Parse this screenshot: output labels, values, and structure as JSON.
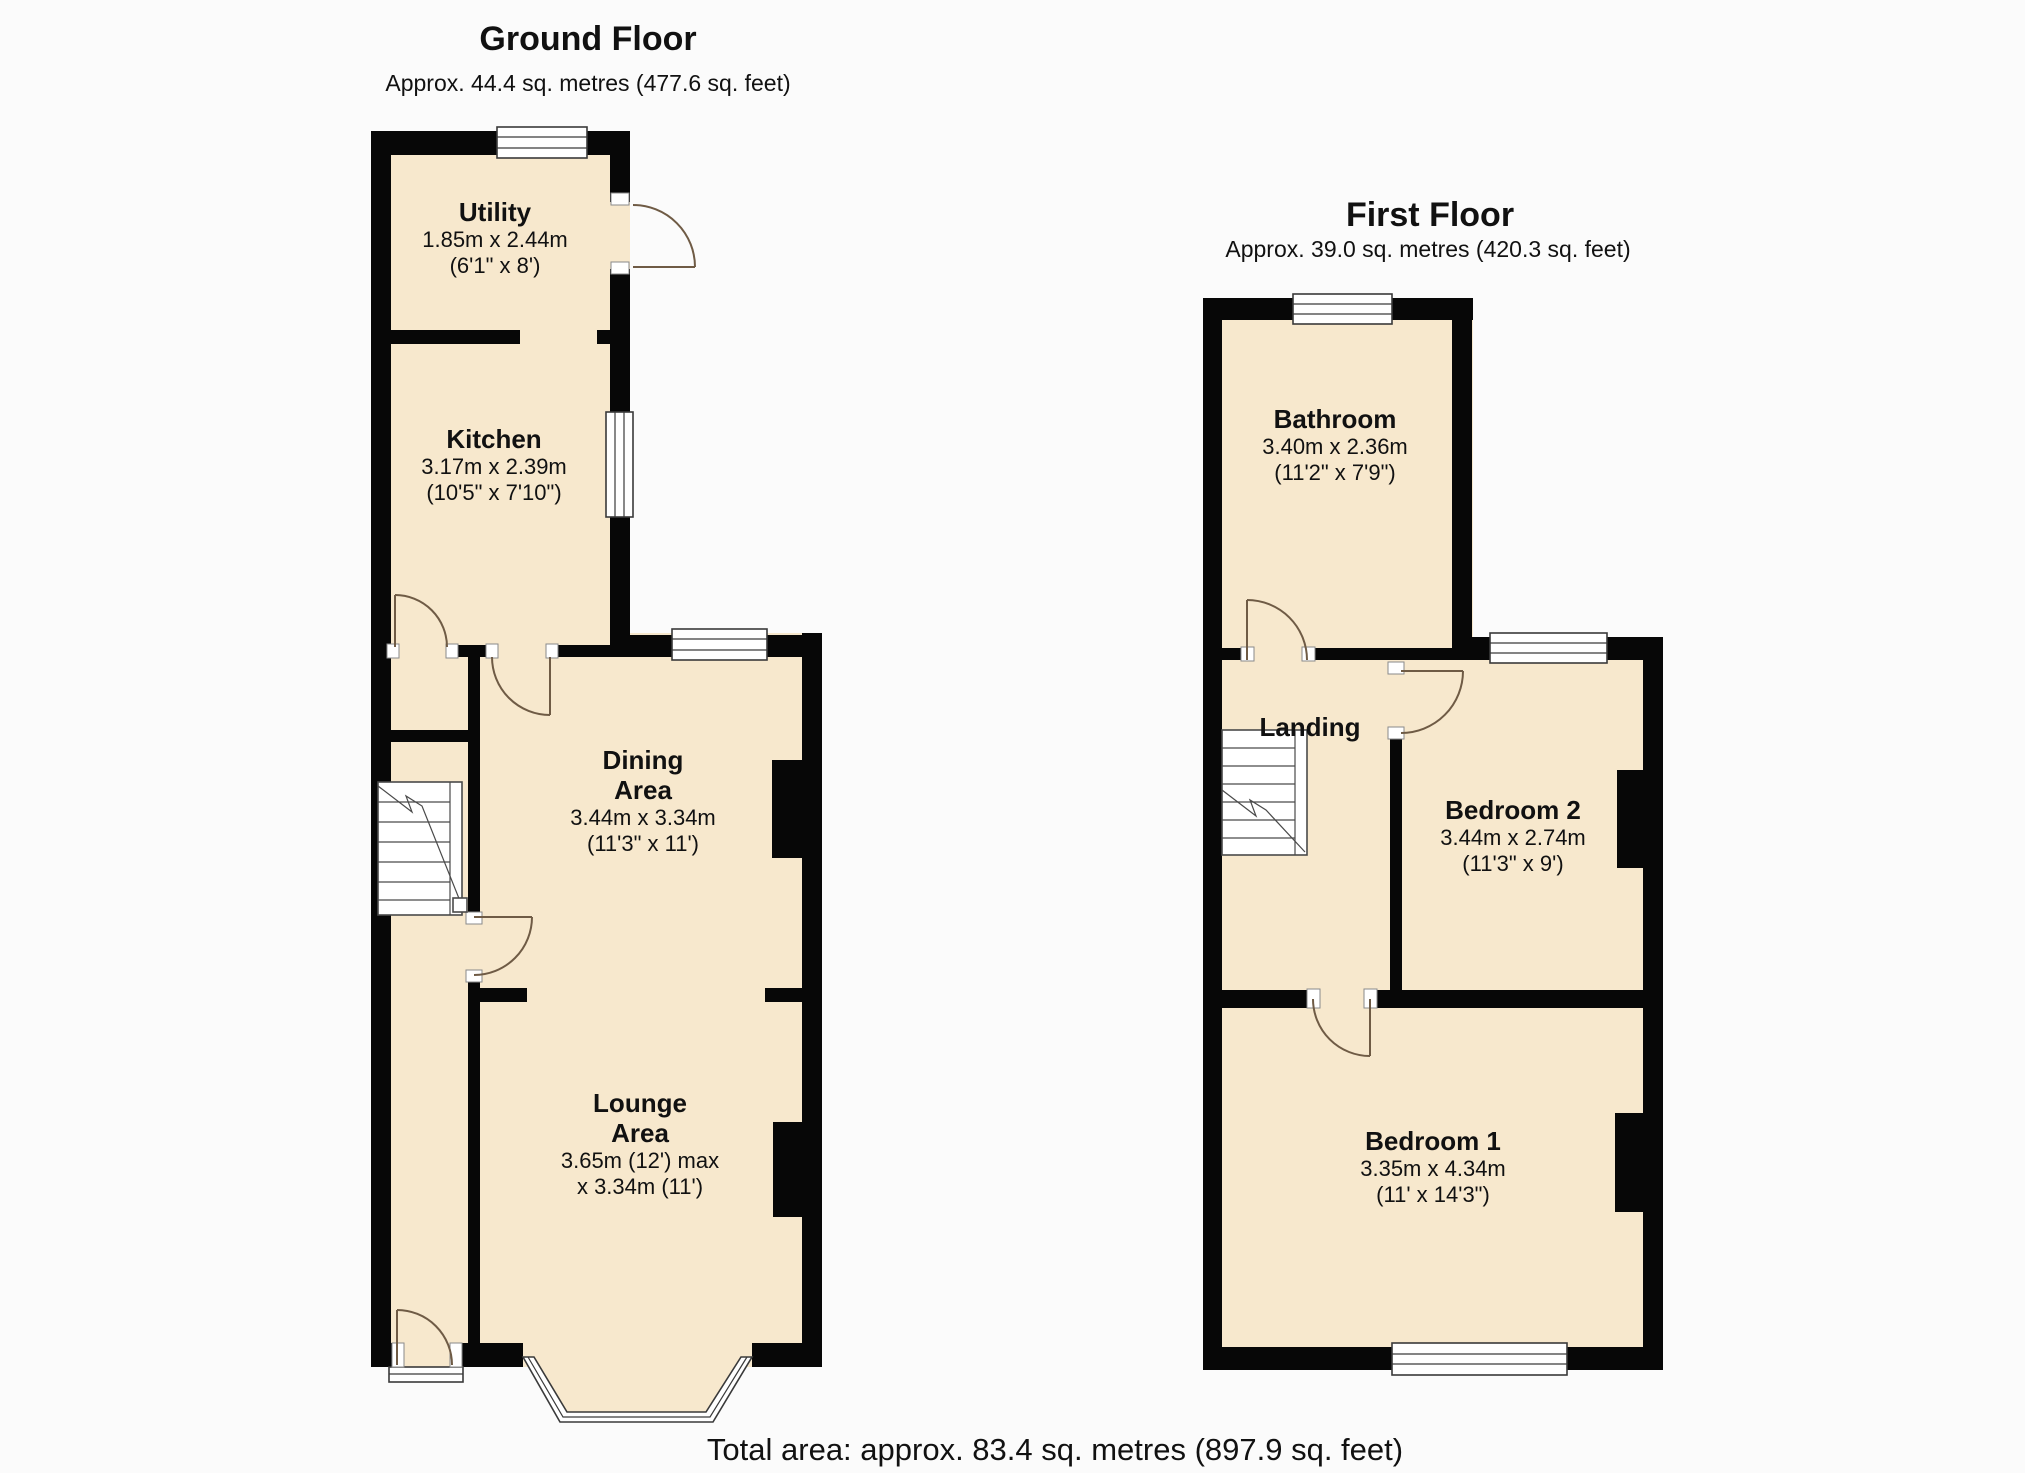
{
  "ground_floor": {
    "title": "Ground Floor",
    "subtitle": "Approx. 44.4 sq. metres (477.6 sq. feet)",
    "rooms": {
      "utility": {
        "name1": "Utility",
        "metric": "1.85m x 2.44m",
        "imperial": "(6'1\" x 8')"
      },
      "kitchen": {
        "name1": "Kitchen",
        "metric": "3.17m x 2.39m",
        "imperial": "(10'5\" x 7'10\")"
      },
      "dining": {
        "name1": "Dining",
        "name2": "Area",
        "metric": "3.44m x 3.34m",
        "imperial": "(11'3\" x 11')"
      },
      "lounge": {
        "name1": "Lounge",
        "name2": "Area",
        "metric": "3.65m (12') max",
        "imperial": "x 3.34m (11')"
      }
    }
  },
  "first_floor": {
    "title": "First Floor",
    "subtitle": "Approx. 39.0 sq. metres (420.3 sq. feet)",
    "rooms": {
      "bathroom": {
        "name1": "Bathroom",
        "metric": "3.40m x 2.36m",
        "imperial": "(11'2\" x 7'9\")"
      },
      "landing": {
        "name1": "Landing"
      },
      "bedroom2": {
        "name1": "Bedroom 2",
        "metric": "3.44m x 2.74m",
        "imperial": "(11'3\" x 9')"
      },
      "bedroom1": {
        "name1": "Bedroom 1",
        "metric": "3.35m x 4.34m",
        "imperial": "(11' x 14'3\")"
      }
    }
  },
  "footer": {
    "total_area": "Total area: approx. 83.4 sq. metres (897.9 sq. feet)"
  },
  "colors": {
    "room_fill": "#f7e8cd",
    "wall": "#070707",
    "door_arc": "#6f5b45",
    "outline": "#3a3a3a",
    "background": "#fbfbfb"
  }
}
